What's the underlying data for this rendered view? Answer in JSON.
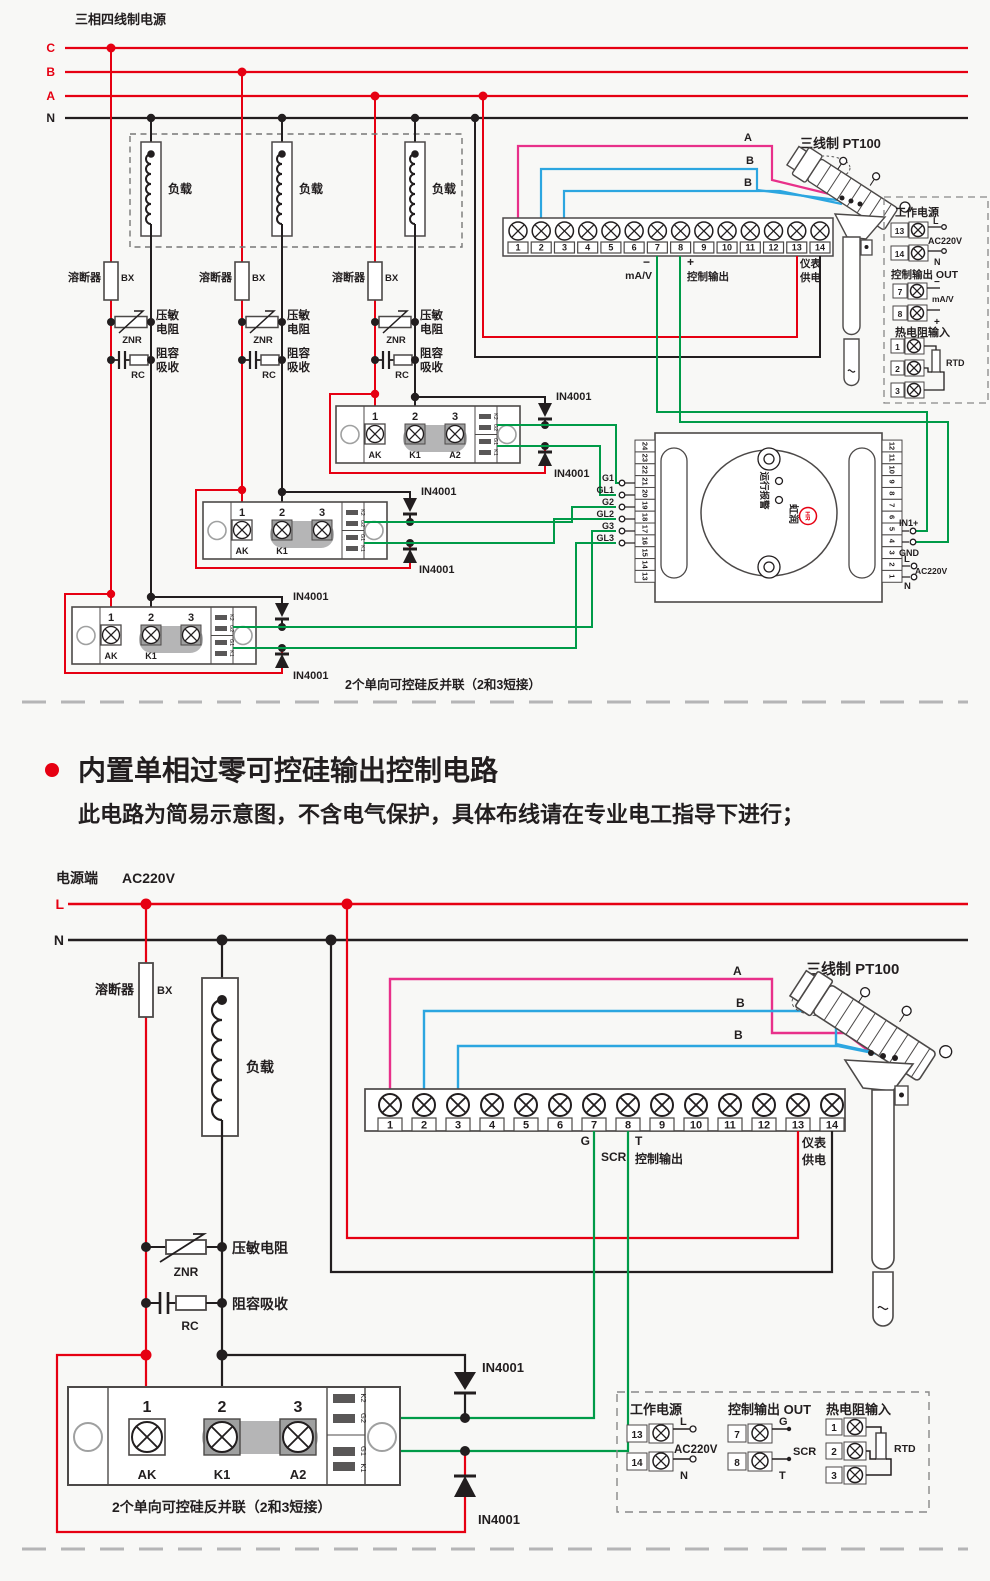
{
  "colors": {
    "red": "#e60012",
    "pink": "#e8308a",
    "blue": "#2ca6e0",
    "green": "#009b48",
    "black": "#221e1f"
  },
  "heading": {
    "title": "内置单相过零可控硅输出控制电路",
    "subtitle": "此电路为简易示意图，不含电气保护，具体布线请在专业电工指导下进行；"
  },
  "common": {
    "load": "负载",
    "fuse": "溶断器",
    "fuse_code": "BX",
    "znr": "ZNR",
    "varistor": "压敏电阻",
    "varistor_l1": "压敏",
    "varistor_l2": "电阻",
    "rc": "RC",
    "snubber": "阻容吸收",
    "snubber_l1": "阻容",
    "snubber_l2": "吸收",
    "diode": "IN4001",
    "scr_caption": "2个单向可控硅反并联（2和3短接）",
    "module": {
      "nums": [
        "1",
        "2",
        "3"
      ],
      "names": [
        "AK",
        "K1",
        "A2"
      ],
      "side": [
        "K2",
        "G2",
        "G1",
        "K1"
      ]
    },
    "terminals": [
      "1",
      "2",
      "3",
      "4",
      "5",
      "6",
      "7",
      "8",
      "9",
      "10",
      "11",
      "12",
      "13",
      "14"
    ],
    "meter1": "仪表",
    "meter2": "供电",
    "pt100": "三线制 PT100",
    "wire_a": "A",
    "wire_b": "B",
    "l": "L",
    "n": "N",
    "ac220": "AC220V",
    "legend": {
      "power": "工作电源",
      "out": "控制输出 OUT",
      "rtd_in": "热电阻输入",
      "rtd": "RTD",
      "t13": "13",
      "t14": "14",
      "t7": "7",
      "t8": "8",
      "t1": "1",
      "t2": "2",
      "t3": "3"
    }
  },
  "top": {
    "title": "三相四线制电源",
    "phases": [
      "C",
      "B",
      "A",
      "N"
    ],
    "out_minus": "−",
    "out_unit": "mA/V",
    "out_plus": "+",
    "out_name": "控制输出",
    "controller": {
      "left": [
        "24",
        "23",
        "22",
        "21",
        "20",
        "19",
        "18",
        "17",
        "16",
        "15",
        "14",
        "13"
      ],
      "right": [
        "12",
        "11",
        "10",
        "9",
        "8",
        "7",
        "6",
        "5",
        "4",
        "3",
        "2",
        "1"
      ],
      "gates": [
        "G1",
        "GL1",
        "G2",
        "GL2",
        "G3",
        "GL3"
      ],
      "run": "运行",
      "alarm": "报警",
      "brand": "虹润",
      "logo": "HR",
      "in1": "IN1+",
      "gnd": "GND"
    }
  },
  "bottom": {
    "power_side": "电源端",
    "g": "G",
    "scr": "SCR",
    "t": "T",
    "out_name": "控制输出"
  }
}
